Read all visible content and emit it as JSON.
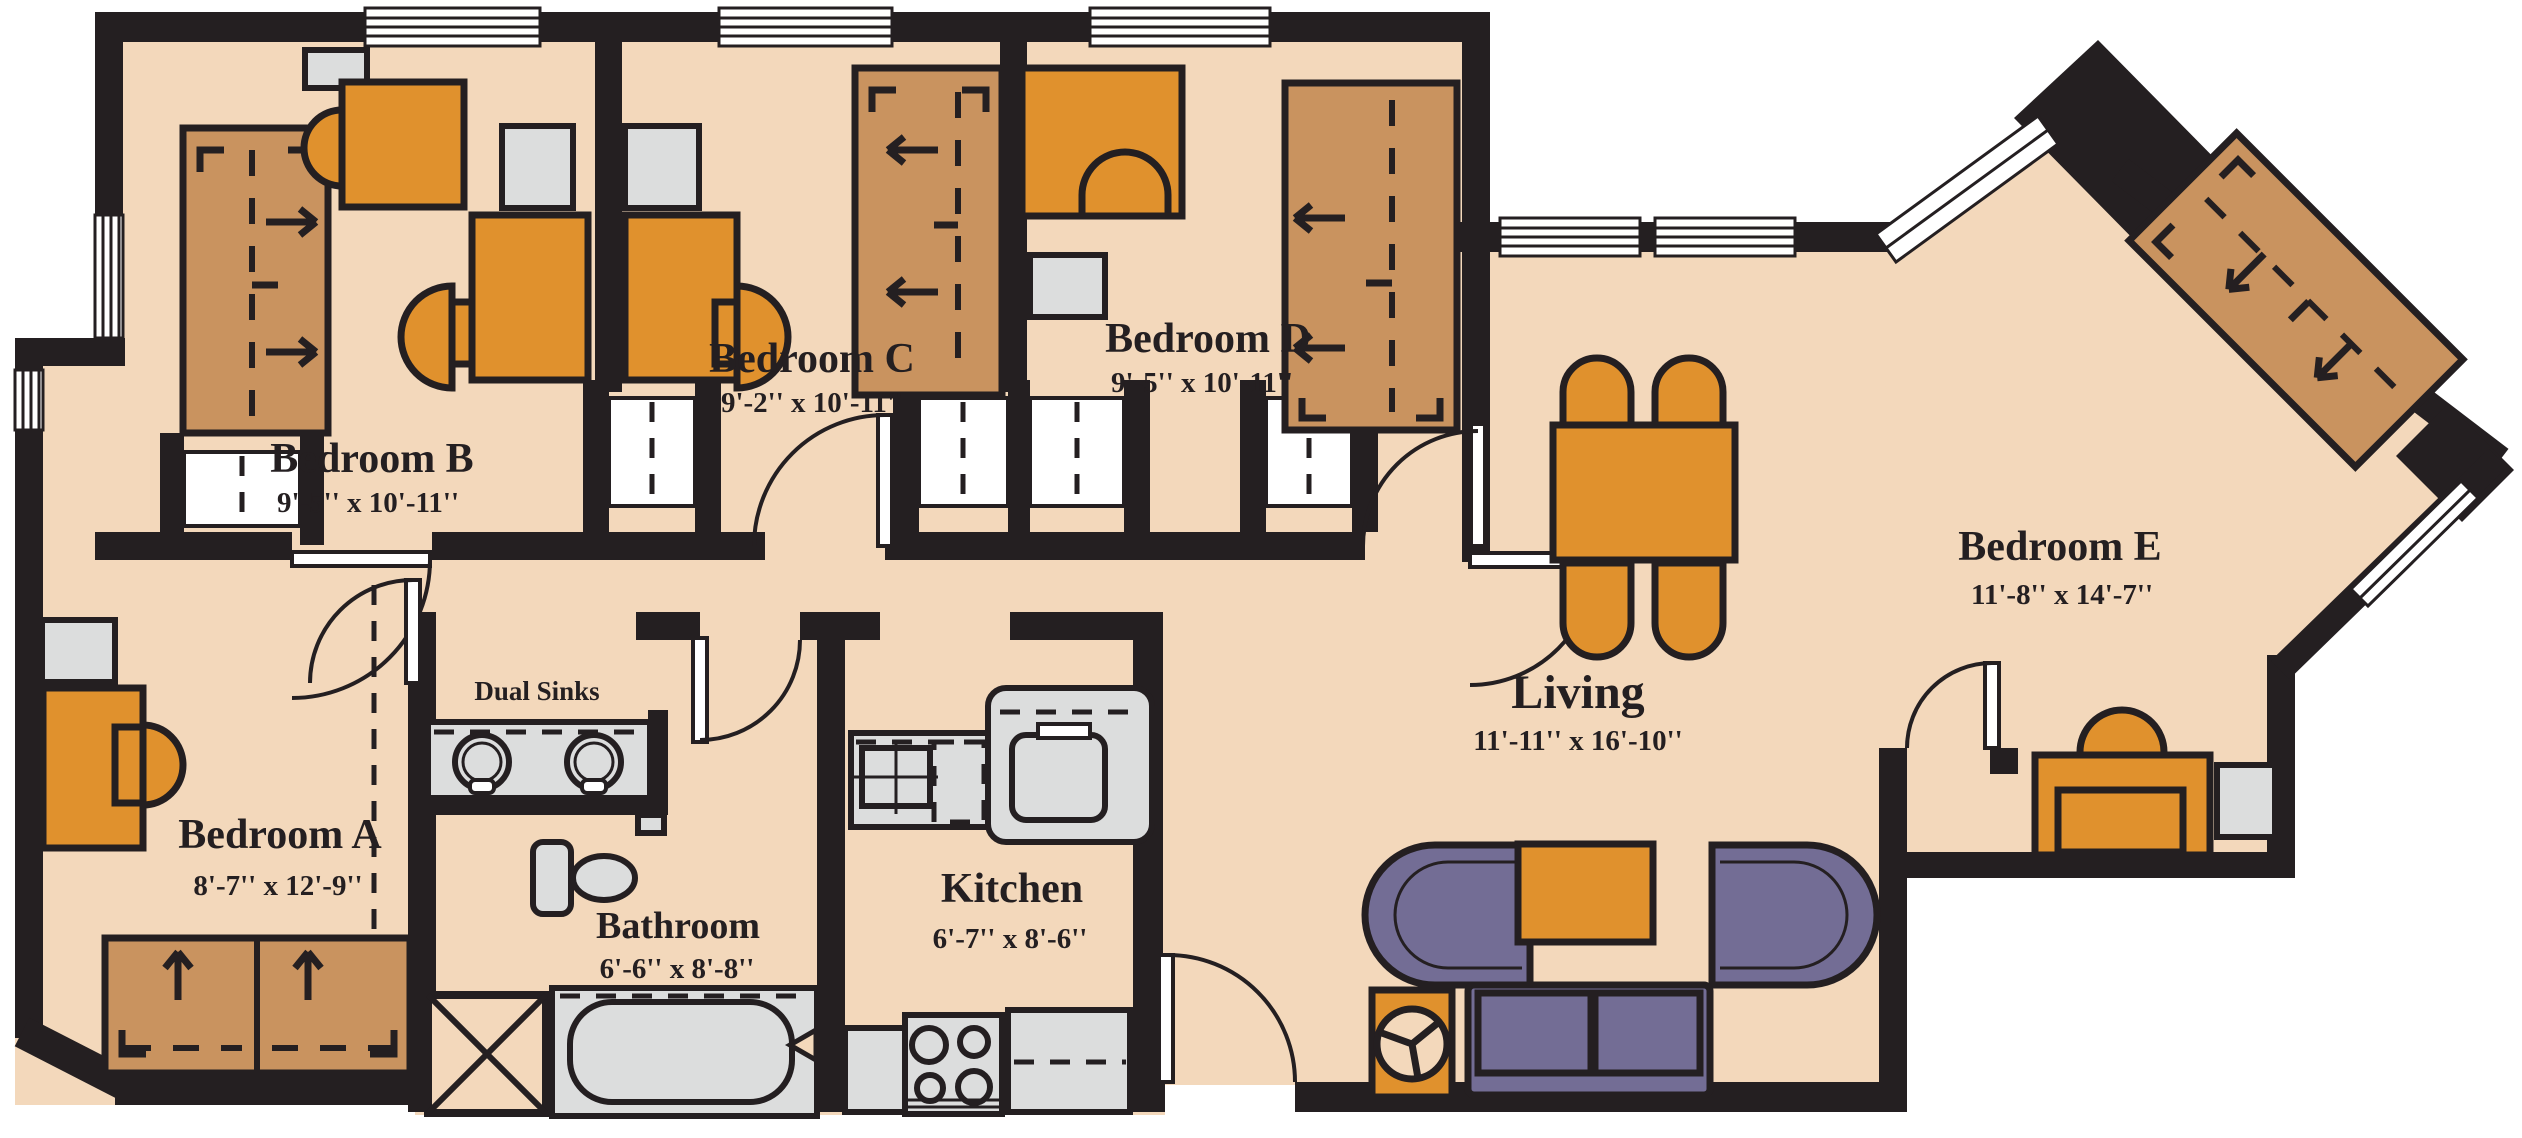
{
  "plan": {
    "type": "apartment floor plan",
    "rooms": [
      {
        "id": "bedroom-a",
        "name": "Bedroom A",
        "dims": "8'-7'' x 12'-9''"
      },
      {
        "id": "bedroom-b",
        "name": "Bedroom B",
        "dims": "9'-5'' x 10'-11''"
      },
      {
        "id": "bedroom-c",
        "name": "Bedroom C",
        "dims": "9'-2'' x 10'-11''"
      },
      {
        "id": "bedroom-d",
        "name": "Bedroom D",
        "dims": "9'-5'' x 10'-11''"
      },
      {
        "id": "bedroom-e",
        "name": "Bedroom E",
        "dims": "11'-8'' x 14'-7''"
      },
      {
        "id": "living",
        "name": "Living",
        "dims": "11'-11'' x 16'-10''"
      },
      {
        "id": "kitchen",
        "name": "Kitchen",
        "dims": "6'-7'' x 8'-6''"
      },
      {
        "id": "bathroom",
        "name": "Bathroom",
        "dims": "6'-6'' x 8'-8''"
      }
    ],
    "annotations": [
      {
        "id": "dual-sinks",
        "label": "Dual Sinks"
      }
    ],
    "colors": {
      "floor": "#f3d8bb",
      "wall": "#241f21",
      "outline": "#241f21",
      "bed_brown": "#c9935f",
      "furniture_orange": "#e0912d",
      "upholstery_purple": "#736d95",
      "fixture_gray": "#dcdddd"
    }
  }
}
